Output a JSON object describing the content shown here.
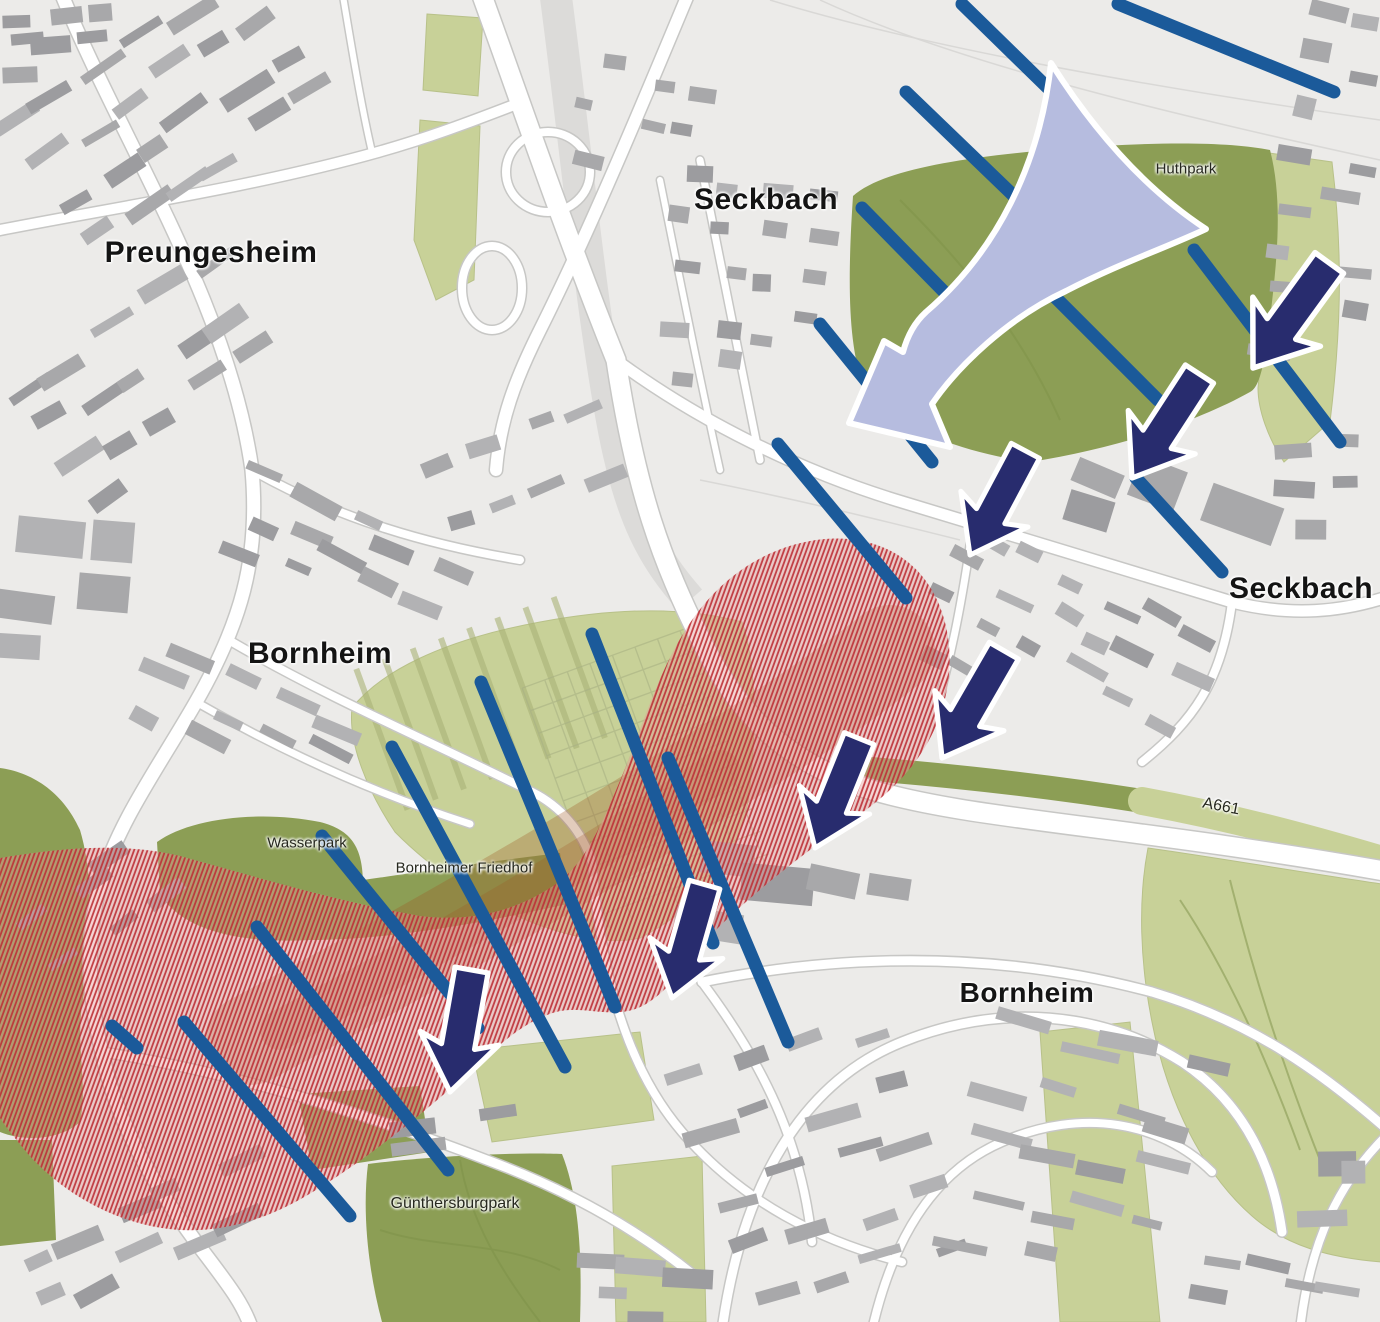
{
  "labels": {
    "districts": [
      {
        "text": "Preungesheim",
        "x": 211,
        "y": 253,
        "size": 30
      },
      {
        "text": "Seckbach",
        "x": 766,
        "y": 200,
        "size": 30
      },
      {
        "text": "Seckbach",
        "x": 1301,
        "y": 589,
        "size": 30
      },
      {
        "text": "Bornheim",
        "x": 320,
        "y": 654,
        "size": 30
      },
      {
        "text": "Bornheim",
        "x": 1027,
        "y": 993,
        "size": 28
      }
    ],
    "places": [
      {
        "text": "Huthpark",
        "x": 1186,
        "y": 169,
        "size": 15,
        "rot": 0
      },
      {
        "text": "Wasserpark",
        "x": 307,
        "y": 843,
        "size": 15,
        "rot": 0
      },
      {
        "text": "Bornheimer Friedhof",
        "x": 464,
        "y": 868,
        "size": 15,
        "rot": 0
      },
      {
        "text": "Günthersburgpark",
        "x": 455,
        "y": 1204,
        "size": 16,
        "rot": 0
      },
      {
        "text": "A661",
        "x": 1221,
        "y": 807,
        "size": 16,
        "rot": 11
      }
    ]
  },
  "colors": {
    "background": "#ecebe9",
    "road_fill": "#ffffff",
    "road_casing": "#c7c7c5",
    "rail_band": "#dcdbd9",
    "building_palette": [
      "#a8a8aa",
      "#9c9c9f",
      "#b2b2b4"
    ],
    "green_dark": "#8c9e55",
    "green_light": "#c8d198",
    "green_detail": "#a9b284",
    "corridor_stripe": "#1b5a9a",
    "flow_arrow": "#282c6e",
    "funnel_fill": "#b6bcdf",
    "outline_white": "#ffffff",
    "red_hatch": "#bd2f36",
    "red_base": "#e59a99",
    "rail_underlay": "#a05522"
  },
  "map": {
    "w": 1380,
    "h": 1322,
    "greens_light": [
      {
        "d": "M352,708 C380,672 442,640 540,622 C610,609 680,605 742,622 C758,668 756,742 748,802 C736,862 700,907 640,938 C580,952 470,908 395,832 C368,792 348,744 352,708 Z"
      },
      {
        "d": "M1148,848 C1200,855 1300,872 1382,884 L1382,1262 C1330,1258 1286,1246 1252,1216 C1204,1174 1168,1104 1152,1022 C1140,962 1138,900 1148,848 Z"
      },
      {
        "d": "M1262,152 L1332,162 C1344,260 1340,340 1330,422 L1284,462 C1268,438 1258,410 1258,388 C1266,300 1270,220 1262,152 Z"
      },
      {
        "d": "M427,14 L483,18 L478,96 L423,90 Z"
      },
      {
        "d": "M420,120 L480,126 L474,280 L436,300 L414,240 Z"
      },
      {
        "d": "M472,1050 L640,1032 L654,1120 L492,1142 Z"
      },
      {
        "d": "M612,1166 L702,1156 L706,1322 L616,1322 Z"
      },
      {
        "d": "M1040,1032 L1130,1022 L1160,1322 L1060,1322 Z"
      }
    ],
    "greens_dark": [
      {
        "d": "M853,196 C880,172 950,158 1060,149 C1160,141 1230,142 1270,150 C1282,196 1278,250 1272,302 C1266,352 1262,386 1250,392 C1200,420 1120,448 1030,462 C960,452 900,428 868,396 C850,360 846,300 853,196 Z"
      },
      {
        "d": "M157,842 C190,818 260,810 320,822 C352,830 362,848 363,880 C420,872 500,860 560,853 L567,904 C470,926 380,940 310,940 C240,944 180,930 160,893 Z"
      },
      {
        "d": "M0,768 C30,772 62,790 80,830 C95,880 92,950 82,1005 C76,1050 88,1085 80,1122 C60,1140 25,1142 0,1132 Z"
      },
      {
        "d": "M0,1140 L52,1140 L56,1240 L0,1246 Z"
      },
      {
        "d": "M298,1094 L420,1086 L430,1152 L312,1170 Z"
      },
      {
        "d": "M368,1164 C430,1156 520,1152 562,1154 C580,1200 582,1260 580,1322 L382,1322 C368,1270 362,1212 368,1164 Z"
      }
    ],
    "green_bands": [
      {
        "d": "M858,768 C960,776 1060,788 1142,801",
        "w": 24,
        "dark": true
      },
      {
        "d": "M1142,801 C1230,817 1308,838 1382,860",
        "w": 28,
        "dark": false
      }
    ],
    "green_paths": [
      {
        "d": "M380,1230 C440,1250 500,1240 560,1270"
      },
      {
        "d": "M460,1160 C470,1220 500,1270 540,1322"
      },
      {
        "d": "M1180,900 C1220,960 1260,1040 1300,1150"
      },
      {
        "d": "M1230,880 C1250,960 1280,1060 1320,1160"
      },
      {
        "d": "M900,200 C960,260 1020,330 1060,420"
      }
    ],
    "cemetery_grid": {
      "cx": 648,
      "cy": 778,
      "w": 175,
      "h": 255,
      "angle": -20,
      "gap": 24
    },
    "field_strips": {
      "cx": 490,
      "cy": 700,
      "w": 230,
      "h": 150,
      "angle": -20,
      "gap": 30
    },
    "rail_band": {
      "d": "M555,-10 C575,140 590,300 612,420 C630,520 655,560 690,600",
      "w": 32
    },
    "roads": [
      {
        "d": "M60,-10 C120,140 228,300 252,470 C260,560 240,625 196,702 C160,765 118,822 101,882 C86,935 87,992 102,1052 C116,1122 152,1182 196,1242 C226,1282 243,1302 252,1330",
        "w": 13
      },
      {
        "d": "M-10,232 C110,208 250,188 378,152 C428,138 470,122 522,102",
        "w": 10
      },
      {
        "d": "M480,-10 C520,100 560,220 616,360 C636,492 662,562 702,642 C742,722 792,762 862,787 C965,820 1120,824 1390,872",
        "w": 19
      },
      {
        "d": "M690,-10 C640,110 590,230 540,330 C515,380 500,420 496,470",
        "w": 12
      },
      {
        "d": "M616,360 C700,422 802,472 902,502 C1002,532 1102,562 1232,602 C1292,617 1342,612 1390,596",
        "w": 11
      },
      {
        "d": "M252,470 C340,520 430,545 520,560",
        "w": 8
      },
      {
        "d": "M232,642 C332,700 432,742 532,792 C562,807 582,832 592,862",
        "w": 8
      },
      {
        "d": "M196,702 C290,756 380,795 470,824",
        "w": 7
      },
      {
        "d": "M592,862 C600,962 622,1062 682,1132 C742,1202 822,1242 902,1262",
        "w": 8
      },
      {
        "d": "M702,982 C852,952 1002,952 1152,992 C1252,1022 1322,1072 1390,1132",
        "w": 9
      },
      {
        "d": "M722,1330 C742,1185 802,1082 902,1042 C1002,1002 1102,1012 1182,1062 C1242,1102 1272,1162 1282,1232",
        "w": 9
      },
      {
        "d": "M872,1330 C892,1242 932,1172 1002,1142 C1082,1107 1162,1122 1212,1172",
        "w": 8
      },
      {
        "d": "M702,982 C762,1062 802,1142 812,1242",
        "w": 8
      },
      {
        "d": "M1232,602 C1222,682 1192,722 1142,762",
        "w": 8
      },
      {
        "d": "M972,532 C962,602 952,652 938,702",
        "w": 7
      },
      {
        "d": "M102,1052 C232,1072 362,1112 492,1162 C572,1192 642,1232 702,1282",
        "w": 9
      },
      {
        "d": "M700,160 C720,260 740,360 760,460",
        "w": 7
      },
      {
        "d": "M660,180 C680,280 700,380 720,470",
        "w": 6
      },
      {
        "d": "M1390,1132 C1340,1180 1310,1240 1300,1330",
        "w": 8
      },
      {
        "d": "M342,-10 C352,50 362,110 372,152",
        "w": 6
      }
    ],
    "loops": [
      {
        "cx": 548,
        "cy": 172,
        "rx": 42,
        "ry": 40,
        "w": 8
      },
      {
        "cx": 492,
        "cy": 288,
        "rx": 30,
        "ry": 42,
        "w": 8
      }
    ],
    "field_lines": [
      {
        "d": "M770,0 C900,40 1100,80 1380,120"
      },
      {
        "d": "M820,0 C950,60 1150,110 1380,160"
      },
      {
        "d": "M700,480 C800,500 880,520 960,540"
      }
    ],
    "building_clusters": [
      {
        "x": 165,
        "y": 110,
        "w": 310,
        "h": 200,
        "n": 24,
        "angle": -33,
        "bw": 40,
        "bh": 12,
        "seed": 11
      },
      {
        "x": 60,
        "y": 42,
        "w": 120,
        "h": 70,
        "n": 7,
        "angle": -5,
        "bw": 30,
        "bh": 13,
        "seed": 21
      },
      {
        "x": 150,
        "y": 385,
        "w": 270,
        "h": 190,
        "n": 16,
        "angle": -33,
        "bw": 36,
        "bh": 13,
        "seed": 31
      },
      {
        "x": 62,
        "y": 595,
        "w": 120,
        "h": 170,
        "n": 5,
        "angle": 6,
        "bw": 56,
        "bh": 34,
        "seed": 41
      },
      {
        "x": 345,
        "y": 560,
        "w": 250,
        "h": 110,
        "n": 12,
        "angle": 25,
        "bw": 36,
        "bh": 12,
        "seed": 51
      },
      {
        "x": 250,
        "y": 722,
        "w": 220,
        "h": 110,
        "n": 10,
        "angle": 25,
        "bw": 34,
        "bh": 12,
        "seed": 61
      },
      {
        "x": 748,
        "y": 280,
        "w": 170,
        "h": 230,
        "n": 18,
        "angle": 5,
        "bw": 22,
        "bh": 14,
        "seed": 71
      },
      {
        "x": 645,
        "y": 120,
        "w": 150,
        "h": 140,
        "n": 7,
        "angle": 10,
        "bw": 22,
        "bh": 13,
        "seed": 81
      },
      {
        "x": 1335,
        "y": 65,
        "w": 85,
        "h": 120,
        "n": 5,
        "angle": 12,
        "bw": 26,
        "bh": 16,
        "seed": 91
      },
      {
        "x": 1320,
        "y": 255,
        "w": 110,
        "h": 260,
        "n": 9,
        "angle": 8,
        "bw": 30,
        "bh": 14,
        "seed": 101
      },
      {
        "x": 1065,
        "y": 645,
        "w": 290,
        "h": 170,
        "n": 20,
        "angle": 28,
        "bw": 30,
        "bh": 12,
        "seed": 111
      },
      {
        "x": 1330,
        "y": 485,
        "w": 95,
        "h": 140,
        "n": 5,
        "angle": 0,
        "bw": 28,
        "bh": 16,
        "seed": 121
      },
      {
        "x": 1165,
        "y": 512,
        "w": 190,
        "h": 85,
        "n": 4,
        "angle": 20,
        "bw": 62,
        "bh": 34,
        "seed": 131
      },
      {
        "x": 805,
        "y": 905,
        "w": 250,
        "h": 100,
        "n": 5,
        "angle": 8,
        "bw": 58,
        "bh": 30,
        "seed": 141
      },
      {
        "x": 820,
        "y": 1165,
        "w": 250,
        "h": 290,
        "n": 20,
        "angle": -18,
        "bw": 42,
        "bh": 12,
        "seed": 151
      },
      {
        "x": 1085,
        "y": 1160,
        "w": 230,
        "h": 280,
        "n": 18,
        "angle": 14,
        "bw": 42,
        "bh": 12,
        "seed": 161
      },
      {
        "x": 150,
        "y": 1255,
        "w": 270,
        "h": 130,
        "n": 11,
        "angle": -25,
        "bw": 36,
        "bh": 12,
        "seed": 171
      },
      {
        "x": 652,
        "y": 1285,
        "w": 150,
        "h": 85,
        "n": 5,
        "angle": 4,
        "bw": 34,
        "bh": 14,
        "seed": 181
      },
      {
        "x": 460,
        "y": 1135,
        "w": 120,
        "h": 60,
        "n": 3,
        "angle": -5,
        "bw": 40,
        "bh": 14,
        "seed": 191
      },
      {
        "x": 520,
        "y": 470,
        "w": 200,
        "h": 120,
        "n": 8,
        "angle": -20,
        "bw": 30,
        "bh": 12,
        "seed": 201
      },
      {
        "x": 95,
        "y": 905,
        "w": 150,
        "h": 90,
        "n": 6,
        "angle": -35,
        "bw": 30,
        "bh": 11,
        "seed": 211
      },
      {
        "x": 1280,
        "y": 1290,
        "w": 170,
        "h": 60,
        "n": 5,
        "angle": 10,
        "bw": 34,
        "bh": 12,
        "seed": 221
      },
      {
        "x": 1345,
        "y": 1195,
        "w": 70,
        "h": 90,
        "n": 3,
        "angle": 0,
        "bw": 34,
        "bh": 20,
        "seed": 231
      }
    ],
    "red_zone": {
      "underlay": [
        {
          "d": "M250,1040 C400,960 560,870 700,780 C780,730 840,690 890,650",
          "w": 90,
          "o": 0.3
        },
        {
          "d": "M280,1030 C430,950 580,865 720,770",
          "w": 40,
          "o": 0.25
        }
      ],
      "blob": "M0,858 C60,848 120,842 180,856 C250,875 330,900 420,916 C470,922 515,912 556,884 C585,864 602,824 622,776 C642,728 658,672 688,626 C718,580 762,548 816,540 C872,532 918,556 938,602 C958,648 952,706 922,752 C900,786 870,808 838,830 C800,856 760,888 724,922 C694,950 676,986 646,1004 C616,1022 584,1004 556,1012 C520,1022 492,1052 458,1082 C410,1124 360,1164 306,1196 C262,1222 212,1236 162,1228 C110,1220 62,1192 28,1154 C18,1142 8,1130 0,1118 Z"
    },
    "stripes": [
      [
        1118,
        4,
        1334,
        92
      ],
      [
        962,
        4,
        1050,
        90
      ],
      [
        906,
        92,
        1016,
        198
      ],
      [
        862,
        208,
        958,
        306
      ],
      [
        820,
        324,
        932,
        462
      ],
      [
        778,
        444,
        906,
        598
      ],
      [
        1002,
        244,
        1158,
        400
      ],
      [
        1194,
        250,
        1340,
        442
      ],
      [
        1136,
        478,
        1222,
        572
      ],
      [
        592,
        634,
        713,
        943
      ],
      [
        481,
        682,
        615,
        1007
      ],
      [
        392,
        747,
        565,
        1067
      ],
      [
        322,
        836,
        478,
        1028
      ],
      [
        257,
        927,
        448,
        1170
      ],
      [
        184,
        1022,
        350,
        1216
      ],
      [
        668,
        758,
        788,
        1042
      ],
      [
        112,
        1026,
        137,
        1048
      ]
    ],
    "stripe_width": 13,
    "funnel": {
      "d": "M1051,63 C1040,165 996,252 926,312 C914,323 907,337 903,352 L884,341 L849,423 L950,447 L932,404 C958,366 1008,318 1066,291 C1118,264 1168,247 1206,229 C1148,191 1096,134 1051,63 Z"
    },
    "arrow_shape": "M0,0 L-38,-52 L-16,-44 L-16,-118 L16,-118 L16,-44 L38,-52 Z",
    "arrows": [
      {
        "x": 1253,
        "y": 368,
        "rot": 36,
        "s": 1.1
      },
      {
        "x": 1132,
        "y": 478,
        "rot": 33,
        "s": 1.05
      },
      {
        "x": 970,
        "y": 555,
        "rot": 28,
        "s": 1.0
      },
      {
        "x": 942,
        "y": 758,
        "rot": 30,
        "s": 1.05
      },
      {
        "x": 815,
        "y": 848,
        "rot": 22,
        "s": 1.0
      },
      {
        "x": 672,
        "y": 998,
        "rot": 16,
        "s": 1.0
      },
      {
        "x": 450,
        "y": 1092,
        "rot": 10,
        "s": 1.05
      }
    ]
  }
}
